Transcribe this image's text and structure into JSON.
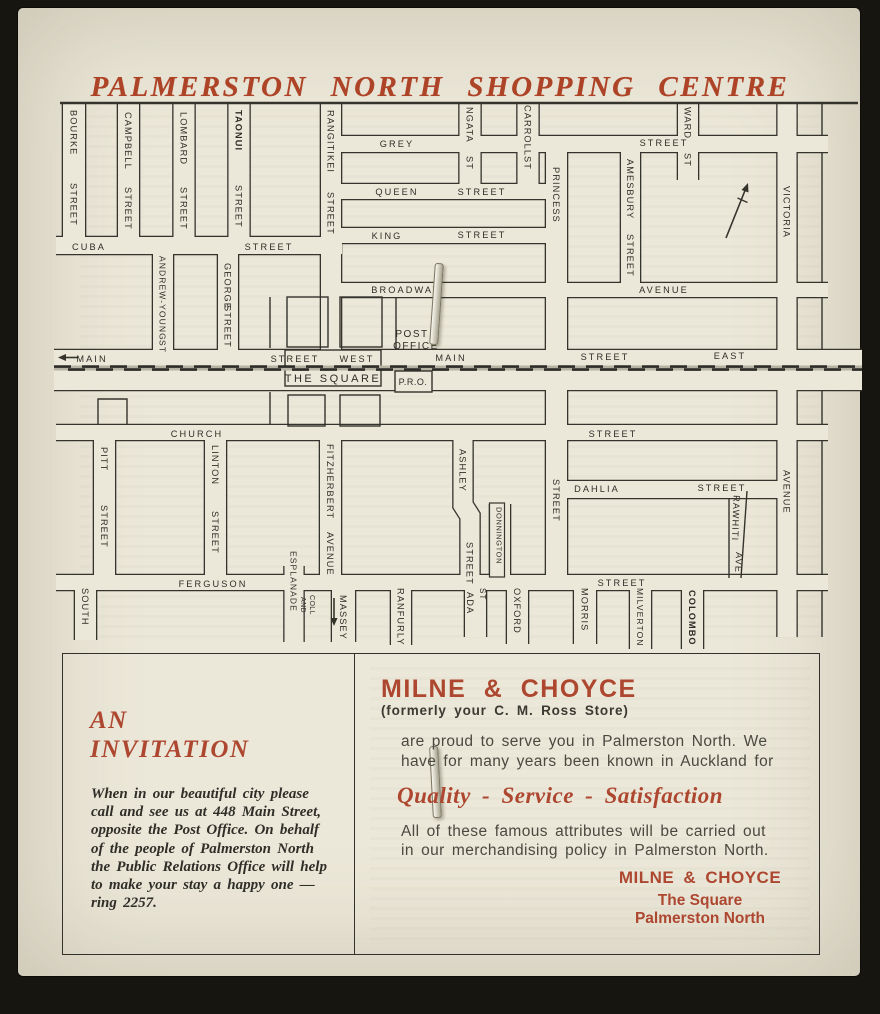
{
  "page_title": "PALMERSTON NORTH SHOPPING CENTRE",
  "colors": {
    "paper": "#ece8d9",
    "ink": "#32312b",
    "accent_red": "#ad4730"
  },
  "map": {
    "square_label": "THE SQUARE",
    "labels": [
      {
        "t": "GREY",
        "x": 397,
        "y": 147,
        "r": 0
      },
      {
        "t": "STREET",
        "x": 664,
        "y": 146,
        "r": 0
      },
      {
        "t": "QUEEN",
        "x": 397,
        "y": 195,
        "r": 0
      },
      {
        "t": "STREET",
        "x": 482,
        "y": 195,
        "r": 0
      },
      {
        "t": "KING",
        "x": 387,
        "y": 239,
        "r": 0
      },
      {
        "t": "STREET",
        "x": 482,
        "y": 238,
        "r": 0
      },
      {
        "t": "BROADWAY",
        "x": 406,
        "y": 293,
        "r": 0
      },
      {
        "t": "AVENUE",
        "x": 664,
        "y": 293,
        "r": 0
      },
      {
        "t": "CUBA",
        "x": 89,
        "y": 250,
        "r": 0
      },
      {
        "t": "STREET",
        "x": 269,
        "y": 250,
        "r": 0
      },
      {
        "t": "MAIN",
        "x": 92,
        "y": 362,
        "r": 0
      },
      {
        "t": "STREET",
        "x": 295,
        "y": 362,
        "r": 0
      },
      {
        "t": "WEST",
        "x": 357,
        "y": 362,
        "r": 0
      },
      {
        "t": "MAIN",
        "x": 451,
        "y": 361,
        "r": 0
      },
      {
        "t": "STREET",
        "x": 605,
        "y": 360,
        "r": 0
      },
      {
        "t": "EAST",
        "x": 730,
        "y": 359,
        "r": 0
      },
      {
        "t": "POST",
        "x": 412,
        "y": 337,
        "r": 0,
        "s": 10,
        "ls": 1.5
      },
      {
        "t": "OFFICE",
        "x": 416,
        "y": 349,
        "r": 0,
        "s": 10,
        "ls": 1.5
      },
      {
        "t": "THE SQUARE",
        "x": 333,
        "y": 382,
        "r": 0,
        "s": 11,
        "ls": 2.5
      },
      {
        "t": "P.R.O.",
        "x": 413,
        "y": 385,
        "r": 0,
        "s": 9,
        "ls": 0.5
      },
      {
        "t": "CHURCH",
        "x": 197,
        "y": 437,
        "r": 0
      },
      {
        "t": "STREET",
        "x": 613,
        "y": 437,
        "r": 0
      },
      {
        "t": "DAHLIA",
        "x": 597,
        "y": 492,
        "r": 0
      },
      {
        "t": "STREET",
        "x": 722,
        "y": 491,
        "r": 0
      },
      {
        "t": "FERGUSON",
        "x": 213,
        "y": 587,
        "r": 0
      },
      {
        "t": "STREET",
        "x": 622,
        "y": 586,
        "r": 0
      },
      {
        "t": "BOURKE",
        "x": 70.5,
        "y": 110,
        "r": 90
      },
      {
        "t": "STREET",
        "x": 70.5,
        "y": 183,
        "r": 90
      },
      {
        "t": "CAMPBELL",
        "x": 125,
        "y": 112,
        "r": 90
      },
      {
        "t": "STREET",
        "x": 125,
        "y": 187,
        "r": 90
      },
      {
        "t": "LOMBARD",
        "x": 180.5,
        "y": 112,
        "r": 90
      },
      {
        "t": "STREET",
        "x": 180.5,
        "y": 187,
        "r": 90
      },
      {
        "t": "TAONUI",
        "x": 235.5,
        "y": 110,
        "r": 90,
        "b": true
      },
      {
        "t": "STREET",
        "x": 235.5,
        "y": 185,
        "r": 90
      },
      {
        "t": "RANGITIKEI",
        "x": 327.5,
        "y": 110,
        "r": 90
      },
      {
        "t": "STREET",
        "x": 327.5,
        "y": 192,
        "r": 90
      },
      {
        "t": "NGATA",
        "x": 466.5,
        "y": 107,
        "r": 90
      },
      {
        "t": "ST",
        "x": 466.5,
        "y": 156,
        "r": 90
      },
      {
        "t": "CARROLL",
        "x": 524.5,
        "y": 105,
        "r": 90
      },
      {
        "t": "ST",
        "x": 524.5,
        "y": 156,
        "r": 90
      },
      {
        "t": "WARD",
        "x": 684.5,
        "y": 107,
        "r": 90
      },
      {
        "t": "ST",
        "x": 684.5,
        "y": 153,
        "r": 90
      },
      {
        "t": "PRINCESS",
        "x": 553,
        "y": 167,
        "r": 90
      },
      {
        "t": "AMESBURY",
        "x": 627,
        "y": 159,
        "r": 90
      },
      {
        "t": "STREET",
        "x": 627,
        "y": 234,
        "r": 90
      },
      {
        "t": "VICTORIA",
        "x": 783.5,
        "y": 186,
        "r": 90
      },
      {
        "t": "AVENUE",
        "x": 783.5,
        "y": 470,
        "r": 90
      },
      {
        "t": "ANDREW-YOUNG",
        "x": 159.5,
        "y": 256,
        "r": 90,
        "s": 8.5
      },
      {
        "t": "ST",
        "x": 159.5,
        "y": 340,
        "r": 90,
        "s": 8.5
      },
      {
        "t": "GEORGE",
        "x": 224.5,
        "y": 263,
        "r": 90
      },
      {
        "t": "STREET",
        "x": 224.5,
        "y": 305,
        "r": 90
      },
      {
        "t": "PITT",
        "x": 101,
        "y": 447,
        "r": 90
      },
      {
        "t": "STREET",
        "x": 101,
        "y": 505,
        "r": 90
      },
      {
        "t": "LINTON",
        "x": 212,
        "y": 445,
        "r": 90
      },
      {
        "t": "STREET",
        "x": 212,
        "y": 511,
        "r": 90
      },
      {
        "t": "FITZHERBERT",
        "x": 327,
        "y": 444,
        "r": 90
      },
      {
        "t": "AVENUE",
        "x": 327,
        "y": 532,
        "r": 90
      },
      {
        "t": "ASHLEY",
        "x": 459.5,
        "y": 449,
        "r": 90
      },
      {
        "t": "STREET",
        "x": 466.5,
        "y": 542,
        "r": 90
      },
      {
        "t": "DONNINGTON",
        "x": 496.5,
        "y": 507,
        "r": 90,
        "s": 7.5,
        "ls": 0.6
      },
      {
        "t": "STREET",
        "x": 553,
        "y": 479,
        "r": 90
      },
      {
        "t": "RAWHITI",
        "x": 733.5,
        "y": 495,
        "r": 92
      },
      {
        "t": "AVE",
        "x": 736,
        "y": 552,
        "r": 92
      },
      {
        "t": "SOUTH",
        "x": 82,
        "y": 588,
        "r": 90
      },
      {
        "t": "ESPLANADE",
        "x": 290.5,
        "y": 551,
        "r": 90,
        "s": 8.5
      },
      {
        "t": "AND",
        "x": 301,
        "y": 597,
        "r": 90,
        "s": 7,
        "ls": 0.4
      },
      {
        "t": "COLL",
        "x": 310,
        "y": 595,
        "r": 90,
        "s": 7,
        "ls": 0.4
      },
      {
        "t": "MASSEY",
        "x": 340,
        "y": 595,
        "r": 90
      },
      {
        "t": "RANFURLY",
        "x": 397.5,
        "y": 588,
        "r": 90
      },
      {
        "t": "ADA",
        "x": 467,
        "y": 592,
        "r": 90
      },
      {
        "t": "ST",
        "x": 480,
        "y": 588,
        "r": 90,
        "s": 8
      },
      {
        "t": "OXFORD",
        "x": 514,
        "y": 588,
        "r": 90
      },
      {
        "t": "MORRIS",
        "x": 581.5,
        "y": 588,
        "r": 90
      },
      {
        "t": "MILVERTON",
        "x": 637,
        "y": 588,
        "r": 90,
        "s": 8.5
      },
      {
        "t": "COLOMBO",
        "x": 689,
        "y": 590,
        "r": 90,
        "b": true
      }
    ]
  },
  "invitation": {
    "heading": [
      "AN",
      "INVITATION"
    ],
    "lines": [
      "When in our beautiful city please",
      "call and see us at 448 Main Street,",
      "opposite the Post Office. On behalf",
      "of the people of Palmerston North",
      "the Public Relations Office will help",
      "to make your stay a happy one —",
      "ring 2257."
    ]
  },
  "milne": {
    "title": "MILNE & CHOYCE",
    "subtitle": "(formerly your C. M. Ross Store)",
    "para1": [
      "are proud to serve you in Palmerston North.  We",
      "have for many years been known in Auckland for"
    ],
    "slogan": "Quality - Service - Satisfaction",
    "para2": [
      "All of these famous attributes will be carried out",
      "in our merchandising policy in Palmerston North."
    ],
    "signoff": [
      "MILNE & CHOYCE",
      "The Square",
      "Palmerston North"
    ]
  }
}
